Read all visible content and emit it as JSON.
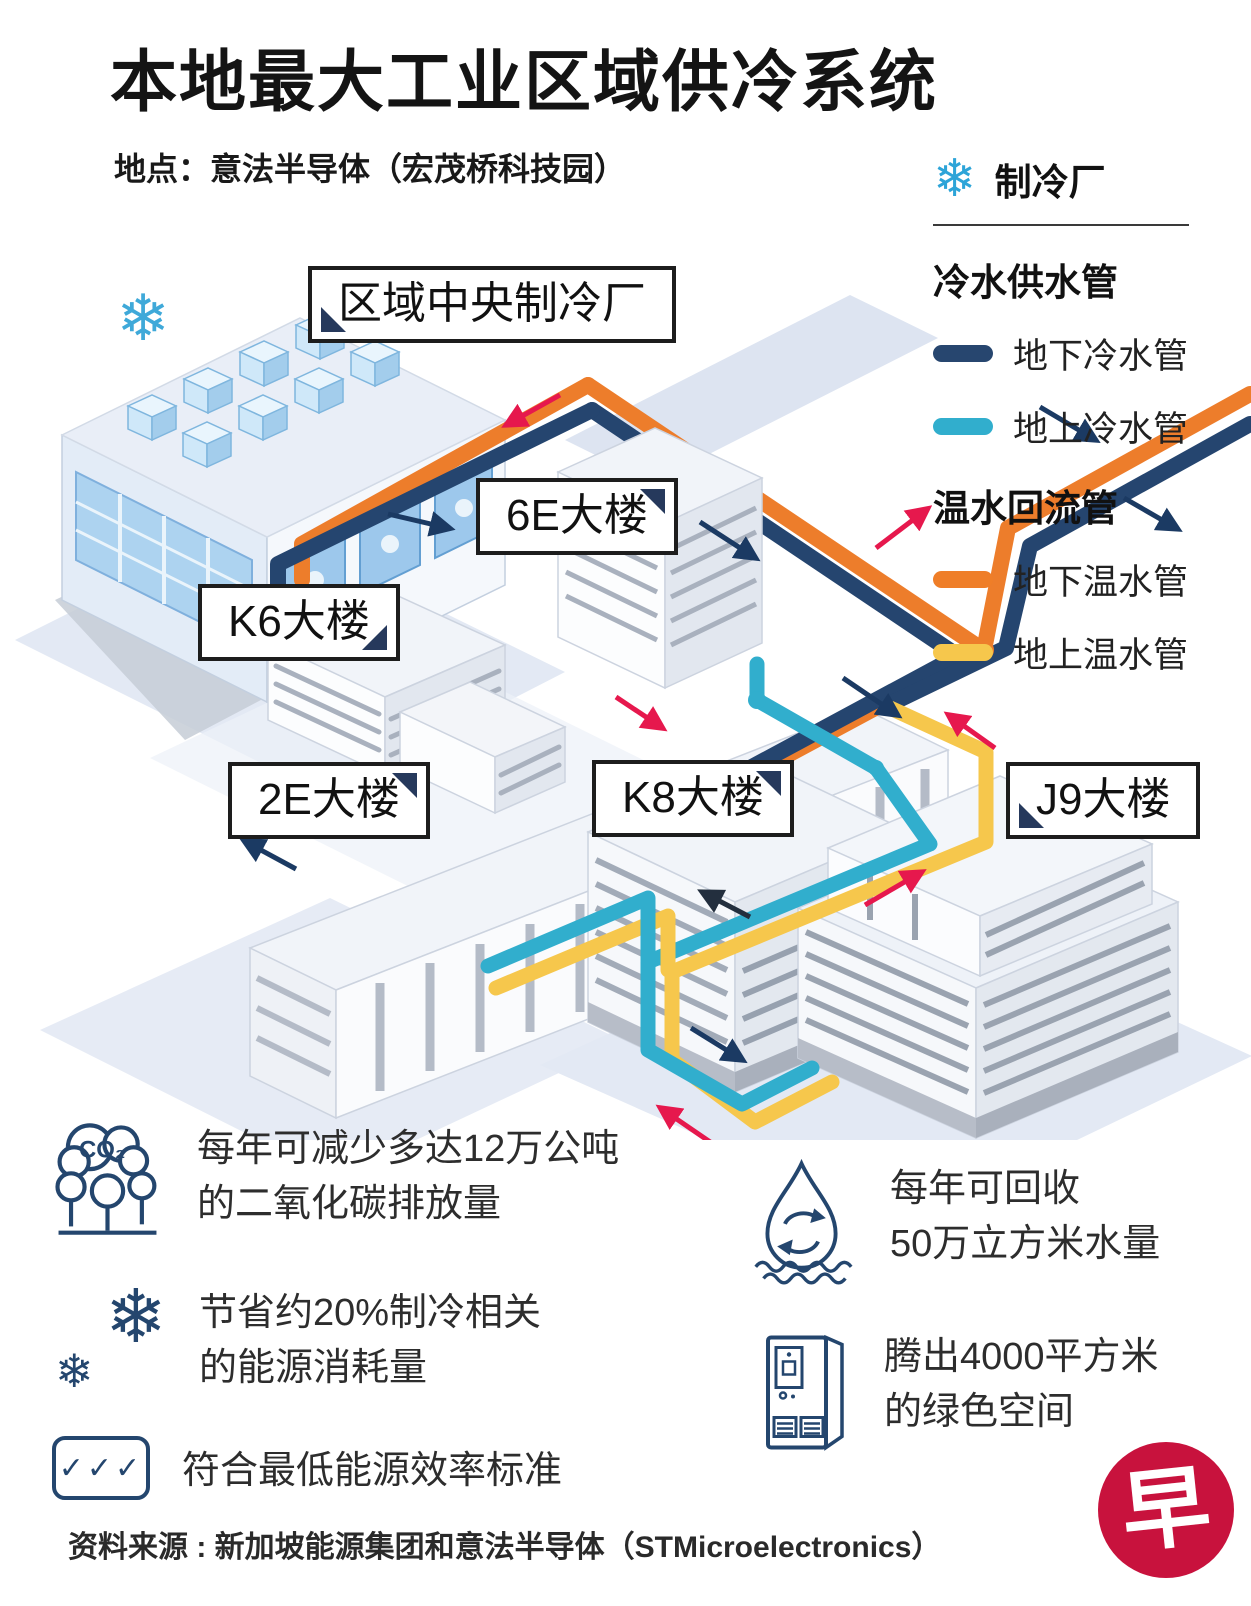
{
  "title": "本地最大工业区域供冷系统",
  "subtitle": "地点：意法半导体（宏茂桥科技园）",
  "icons": {
    "snowflake": "❄",
    "checks": "✓✓✓",
    "co2_label": "CO₂"
  },
  "legend": {
    "plant_label": "制冷厂",
    "cold_heading": "冷水供水管",
    "cold_items": [
      {
        "label": "地下冷水管",
        "color": "#27466f"
      },
      {
        "label": "地上冷水管",
        "color": "#31aecd"
      }
    ],
    "warm_heading": "温水回流管",
    "warm_items": [
      {
        "label": "地下温水管",
        "color": "#ef7e28"
      },
      {
        "label": "地上温水管",
        "color": "#f6c74c"
      }
    ]
  },
  "buildings": {
    "plant": "区域中央制冷厂",
    "b6e": "6E大楼",
    "k6": "K6大楼",
    "b2e": "2E大楼",
    "k8": "K8大楼",
    "j9": "J9大楼"
  },
  "stats": [
    {
      "id": "co2",
      "lines": [
        "每年可减少多达12万公吨",
        "的二氧化碳排放量"
      ]
    },
    {
      "id": "energy",
      "lines": [
        "节省约20%制冷相关",
        "的能源消耗量"
      ]
    },
    {
      "id": "standard",
      "lines": [
        "符合最低能源效率标准"
      ]
    },
    {
      "id": "water",
      "lines": [
        "每年可回收",
        "50万立方米水量"
      ]
    },
    {
      "id": "space",
      "lines": [
        "腾出4000平方米",
        "的绿色空间"
      ]
    }
  ],
  "source": "资料来源 : 新加坡能源集团和意法半导体（STMicroelectronics）",
  "logo": {
    "char": "早",
    "color": "#c8123d"
  },
  "colors": {
    "underground_cold_pipe": "#27466f",
    "above_ground_cold_pipe": "#31aecd",
    "underground_warm_pipe": "#ef7e28",
    "above_ground_warm_pipe": "#f6c74c",
    "warm_flow_arrow": "#e6184d",
    "cold_flow_arrow": "#1b3a63",
    "logo_red": "#c8123d"
  }
}
